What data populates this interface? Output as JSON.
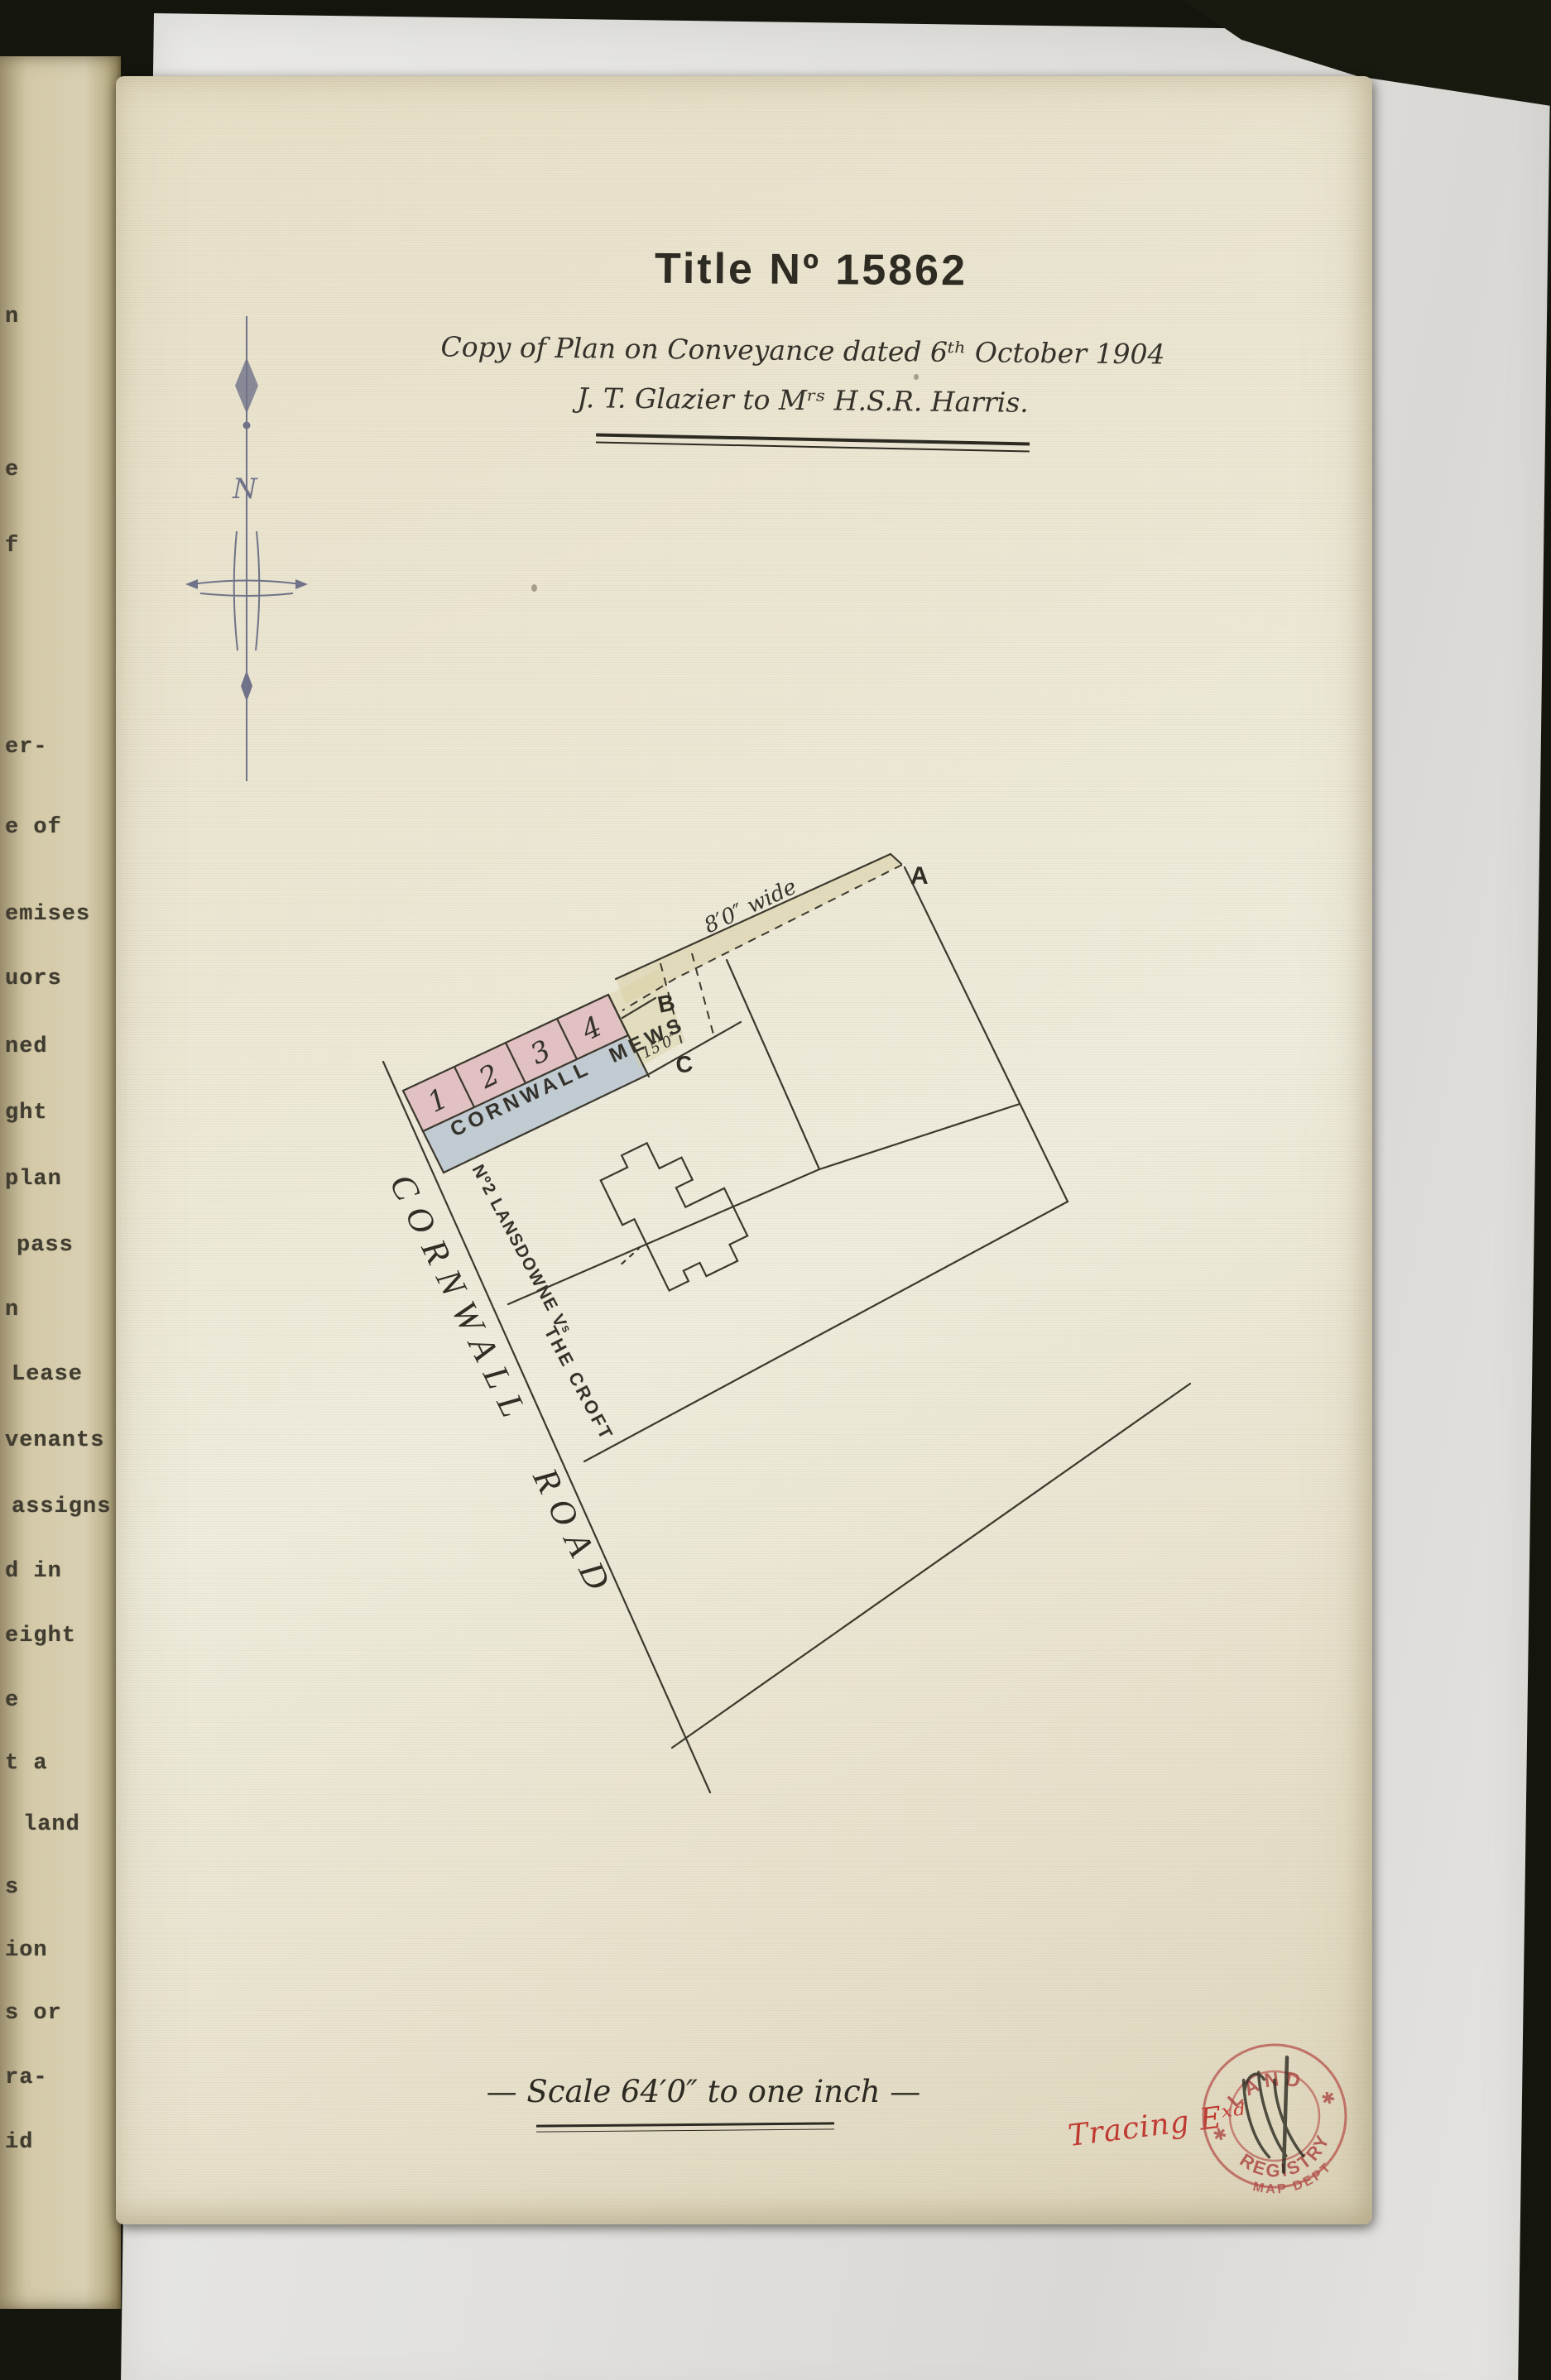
{
  "page": {
    "title": "Title Nº 15862",
    "subtitle_line1": "Copy of Plan on Conveyance dated 6ᵗʰ October 1904",
    "subtitle_line2": "J. T. Glazier to Mʳˢ H.S.R. Harris.",
    "scale_note": "— Scale 64′0″ to one inch —",
    "tracing_note": "Tracing Eˣᵈ"
  },
  "plan": {
    "plot_numbers": [
      "1",
      "2",
      "3",
      "4"
    ],
    "mews_label": "CORNWALL MEWS",
    "road_label": "CORNWALL ROAD",
    "lansdowne_label": "Nº2 LANSDOWNE Vˢ",
    "croft_label": "THE CROFT",
    "passage_width_label": "8′0″ wide",
    "plot_depth_label": "15′0″",
    "marker_a": "A",
    "marker_b": "B",
    "marker_c": "C",
    "compass_north_label": "N"
  },
  "stamp": {
    "top_arc": "LAND",
    "bottom_arc": "REGISTRY",
    "dept_arc": "MAP DEPT",
    "star_left": "✱",
    "star_right": "✱"
  },
  "left_page_fragments": [
    {
      "text": "n"
    },
    {
      "text": "e"
    },
    {
      "text": "f"
    },
    {
      "text": "er-"
    },
    {
      "text": "e of"
    },
    {
      "text": "emises"
    },
    {
      "text": "uors"
    },
    {
      "text": "ned"
    },
    {
      "text": "ght"
    },
    {
      "text": "plan"
    },
    {
      "text": "pass"
    },
    {
      "text": "n"
    },
    {
      "text": "Lease"
    },
    {
      "text": "venants"
    },
    {
      "text": "assigns"
    },
    {
      "text": "d in"
    },
    {
      "text": "eight"
    },
    {
      "text": "e"
    },
    {
      "text": "t a"
    },
    {
      "text": "land"
    },
    {
      "text": "s"
    },
    {
      "text": "ion"
    },
    {
      "text": "s or"
    },
    {
      "text": "ra-"
    },
    {
      "text": "id"
    }
  ],
  "colors": {
    "plot_pink": "#dfb6be",
    "mews_blue": "#b5c3d0",
    "passage_yellow": "#d8d0a4",
    "ink": "#3b382d",
    "compass_blue": "#5b5f7d",
    "stamp_red": "#b5524b",
    "tracing_red": "#bf3a31",
    "page_cream": "#eae4cf",
    "old_page_tan": "#d2c8a6"
  }
}
